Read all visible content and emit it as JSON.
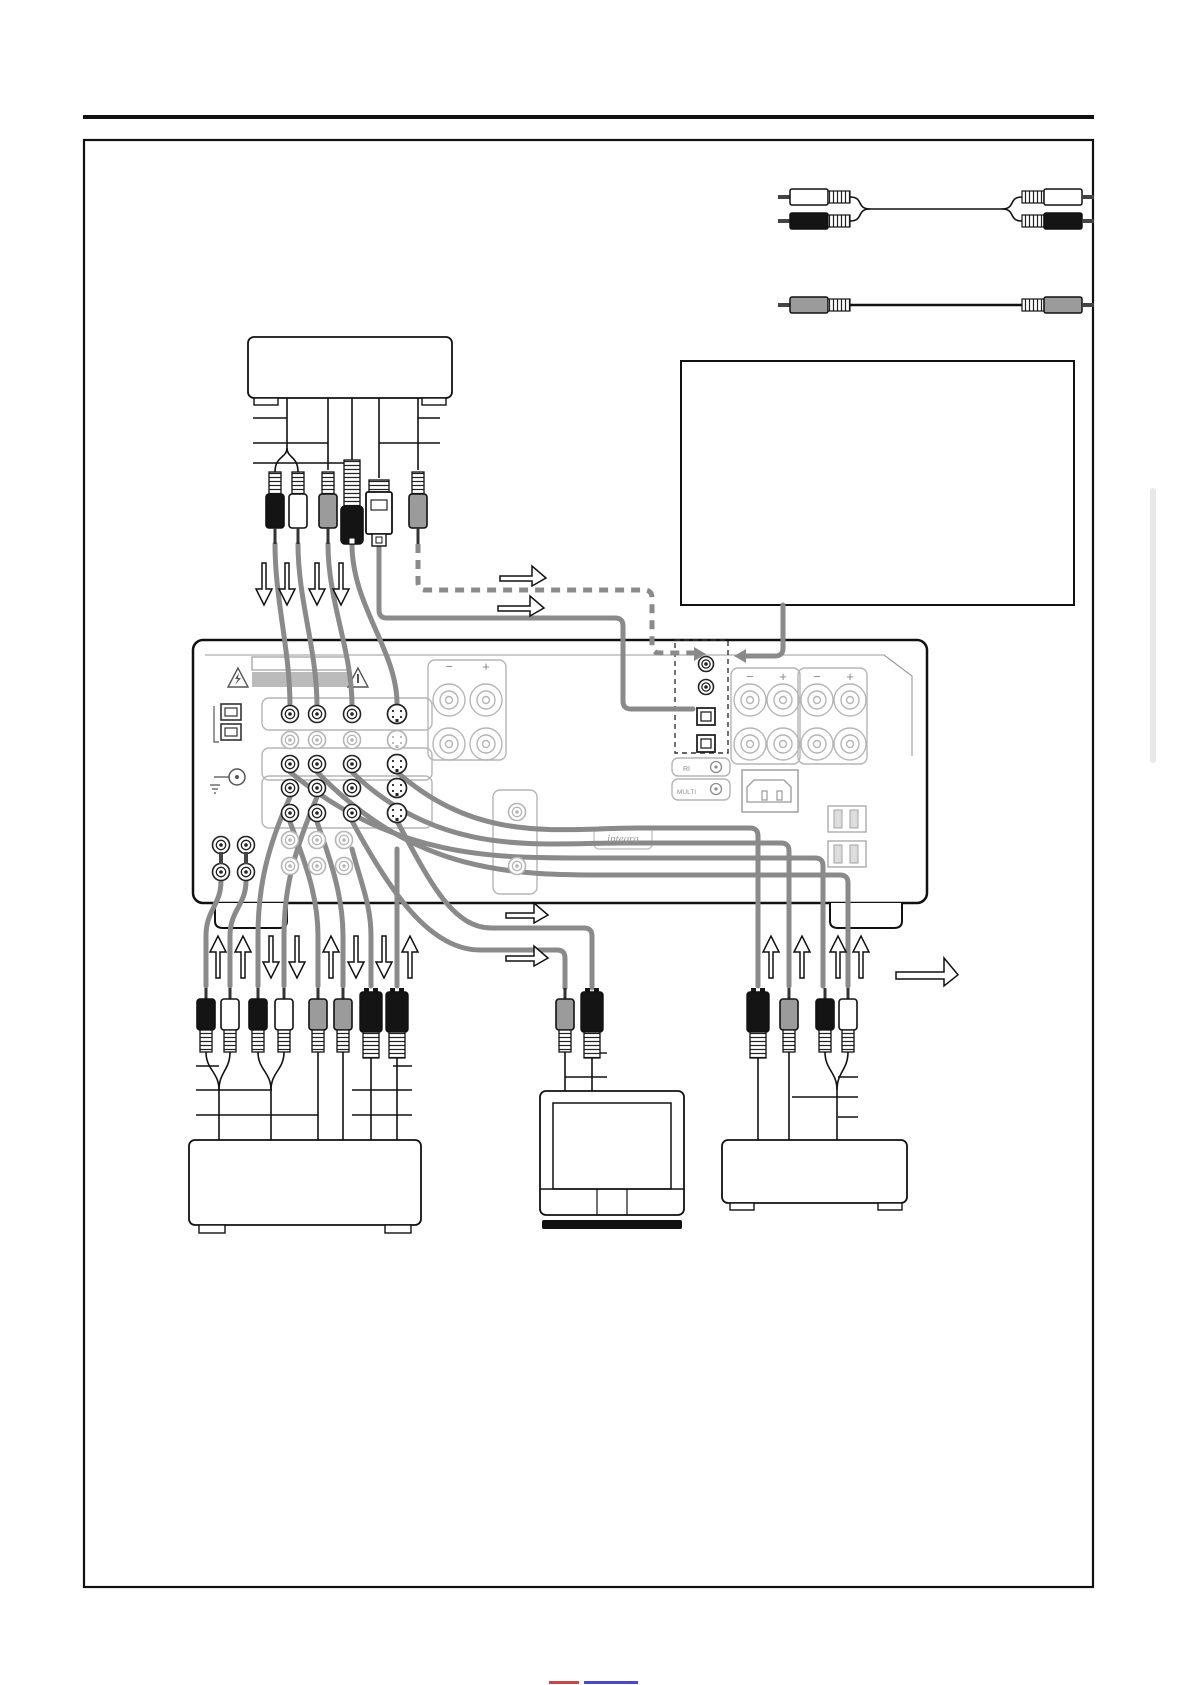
{
  "document": {
    "kind": "av-receiver rear-panel connection diagram page",
    "visible_text_note": "page contains almost no text; only speaker polarity marks, brand plate and two tiny jack labels"
  },
  "labels": {
    "speaker_minus": "−",
    "speaker_plus": "+",
    "brand_logo": "integra",
    "mini_jacks": [
      "RI",
      "MULTI"
    ]
  },
  "footer": {
    "cropped_link_fragments": [
      [
        549,
        1681,
        30,
        3,
        "#c24a4a"
      ],
      [
        584,
        1681,
        54,
        3,
        "#4a4ac2"
      ]
    ]
  },
  "colors": {
    "cable_gray": "#8a8a8a",
    "plug_black": "#141414",
    "plug_white": "#ffffff",
    "plug_gray": "#9b9b9b",
    "panel_light": "#b5b5b5",
    "page_tab_gray": "#e8e8e8"
  },
  "legend_cables": {
    "stereo_audio_cable": {
      "type": "rca-stereo-pair",
      "connector_colors": [
        "white",
        "black"
      ],
      "y1": 197,
      "y2": 221,
      "mid_y": 209,
      "x0": 790,
      "x1": 1082
    },
    "video_cable": {
      "type": "rca-mono",
      "connector_colors": [
        "gray"
      ],
      "y": 305,
      "x0": 790,
      "x1": 1082
    }
  },
  "geometry": {
    "page_rule": [
      83,
      115,
      1094,
      4
    ],
    "outer_box": [
      84,
      140,
      1009,
      1447
    ],
    "gray_strip": [
      1150,
      488,
      6,
      275
    ],
    "note_box": [
      681,
      361,
      393,
      244
    ],
    "top_device": {
      "box": [
        248,
        337,
        204,
        61
      ],
      "feet": [
        [
          254,
          398,
          24,
          7
        ],
        [
          422,
          398,
          24,
          7
        ]
      ]
    },
    "left_device": {
      "box": [
        189,
        1140,
        232,
        85
      ],
      "feet": [
        [
          199,
          1225,
          26,
          8
        ],
        [
          385,
          1225,
          26,
          8
        ]
      ]
    },
    "right_device": {
      "box": [
        722,
        1140,
        185,
        63
      ],
      "feet": [
        [
          730,
          1203,
          24,
          7
        ],
        [
          878,
          1203,
          24,
          7
        ]
      ]
    },
    "tv": {
      "box": [
        540,
        1091,
        144,
        124
      ],
      "screen": [
        553,
        1103,
        118,
        86
      ],
      "band_y": 1189,
      "dividers": [
        597,
        627
      ],
      "base": [
        542,
        1220,
        140,
        9
      ]
    }
  },
  "receiver": {
    "panel": [
      193,
      640,
      734,
      263
    ],
    "bevel": "M205,655 H884 L912,676 V756",
    "feet": [
      "M215,903 v18 q0,7 8,7 h56 q8,0 8,-7 v-18",
      "M830,903 v18 q0,7 8,7 h56 q8,0 8,-7 v-18"
    ],
    "warn_strip_outline": [
      252,
      657,
      96,
      13
    ],
    "warn_strip_fill": [
      252,
      672,
      96,
      15
    ],
    "warn_triangles": [
      [
        238,
        678
      ],
      [
        358,
        678
      ]
    ],
    "optical_in_left": [
      [
        221,
        704
      ],
      [
        221,
        724
      ]
    ],
    "ground": {
      "circle": [
        237,
        777,
        8
      ],
      "lead": [
        214,
        777,
        229,
        777
      ]
    },
    "jack_cols": [
      290,
      317,
      352
    ],
    "svideo_col": 397,
    "jack_rows": [
      {
        "y": 714,
        "tone": "dark",
        "sv": true
      },
      {
        "y": 740,
        "tone": "light",
        "sv": true
      },
      {
        "y": 764,
        "tone": "dark",
        "sv": true
      },
      {
        "y": 788,
        "tone": "dark",
        "sv": true
      },
      {
        "y": 813,
        "tone": "dark",
        "sv": true
      },
      {
        "y": 840,
        "tone": "light",
        "sv": false,
        "cols": [
          290,
          317,
          344
        ]
      },
      {
        "y": 866,
        "tone": "light",
        "sv": false,
        "cols": [
          290,
          317,
          344
        ]
      }
    ],
    "extra_light_jacks": [
      [
        517,
        812
      ],
      [
        517,
        866
      ]
    ],
    "quad_jacks": [
      [
        221,
        845
      ],
      [
        246,
        845
      ],
      [
        221,
        872
      ],
      [
        246,
        872
      ]
    ],
    "group_rects": [
      [
        262,
        698,
        170,
        32
      ],
      [
        262,
        748,
        170,
        32
      ],
      [
        262,
        776,
        170,
        52
      ],
      [
        493,
        790,
        44,
        104
      ],
      [
        428,
        660,
        78,
        100
      ],
      [
        731,
        668,
        69,
        96
      ],
      [
        798,
        668,
        69,
        96
      ]
    ],
    "digital_box": [
      675,
      640,
      53,
      113
    ],
    "coax_jacks": [
      [
        706,
        664
      ],
      [
        706,
        687
      ]
    ],
    "optical_jacks": [
      [
        697,
        708
      ],
      [
        697,
        735
      ]
    ],
    "center_speakers": {
      "cols": [
        449,
        486
      ],
      "rows": [
        700,
        744
      ],
      "label_y": 671,
      "labels": [
        "speaker_minus",
        "speaker_plus"
      ]
    },
    "right_speakers": {
      "cols": [
        750,
        783,
        817,
        850
      ],
      "rows": [
        700,
        744
      ],
      "label_y": 681,
      "labels": [
        "speaker_minus",
        "speaker_plus",
        "speaker_minus",
        "speaker_plus"
      ]
    },
    "ac_inlet": {
      "outer": [
        742,
        770,
        56,
        42
      ],
      "inner": "M754,780 h30 l7,7 v15 h-44 v-15 z",
      "pins": [
        [
          762,
          791,
          5,
          9
        ],
        [
          777,
          791,
          5,
          9
        ]
      ]
    },
    "outlets": [
      [
        828,
        806,
        38,
        26
      ],
      [
        828,
        841,
        38,
        26
      ]
    ],
    "logo_plate": [
      594,
      827,
      58,
      22
    ],
    "mini_jack_plates": [
      [
        672,
        758,
        58,
        18
      ],
      [
        672,
        779,
        58,
        21
      ]
    ],
    "mini_jack_circles": [
      [
        716,
        767
      ],
      [
        716,
        789
      ]
    ]
  },
  "cables": {
    "gray": [
      {
        "name": "source-audio-left",
        "d": "M275,544 C275,600 290,650 290,706"
      },
      {
        "name": "source-audio-right",
        "d": "M298,544 C298,600 317,650 317,706"
      },
      {
        "name": "source-video",
        "d": "M328,544 C328,602 352,650 352,706"
      },
      {
        "name": "source-svideo",
        "d": "M352,544 C352,606 397,650 397,704"
      },
      {
        "name": "optical-digital",
        "d": "M379,546 V610 Q379,618 387,618 H615 Q623,618 623,626 V701 Q623,709 631,709 H693"
      },
      {
        "name": "note-box-lead",
        "d": "M783,605 V648 Q783,656 775,656 H744"
      },
      {
        "name": "right-svideo",
        "d": "M397,772 C480,845 560,828 640,828 H750 Q758,828 758,836 V986"
      },
      {
        "name": "right-video",
        "d": "M352,772 C440,858 540,843 620,843 H781 Q789,843 789,851 V986"
      },
      {
        "name": "right-audio-l",
        "d": "M290,772 C400,862 500,858 600,858 H815 Q823,858 823,866 V986"
      },
      {
        "name": "right-audio-r",
        "d": "M317,772 C420,878 520,875 620,875 H840 Q848,875 848,883 V986"
      },
      {
        "name": "tv-video",
        "d": "M352,821 C390,892 430,950 480,950 H557 Q565,950 565,958 V988"
      },
      {
        "name": "tv-svideo",
        "d": "M397,821 C430,882 452,928 492,928 H584 Q592,928 592,936 V988"
      },
      {
        "name": "left-1",
        "d": "M221,881 C221,905 206,910 206,936 V986"
      },
      {
        "name": "left-2",
        "d": "M246,881 C246,905 230,910 230,936 V986"
      },
      {
        "name": "left-3",
        "d": "M290,797 C265,852 258,892 258,936 V986"
      },
      {
        "name": "left-4",
        "d": "M317,797 C292,856 284,892 284,936 V986"
      },
      {
        "name": "left-5",
        "d": "M290,822 C305,862 318,896 318,936 V986"
      },
      {
        "name": "left-6",
        "d": "M317,822 C332,864 343,898 343,936 V986"
      },
      {
        "name": "left-7",
        "d": "M352,849 C362,886 371,906 371,936 V986"
      },
      {
        "name": "left-8",
        "d": "M397,849 V986"
      }
    ],
    "dashed": [
      {
        "name": "coax-digital-dashed",
        "d": "M418,544 V582 Q418,590 426,590 H644 Q652,590 652,598 V645 Q652,653 660,653 H694"
      }
    ],
    "arrowheads": [
      [
        [
          694,
          647
        ],
        [
          706,
          654
        ],
        [
          694,
          661
        ]
      ],
      [
        [
          746,
          649
        ],
        [
          734,
          656
        ],
        [
          746,
          663
        ]
      ]
    ],
    "thin": [
      "M287,398 V448",
      "M328,398 V470",
      "M352,398 V460",
      "M379,398 V478",
      "M418,398 V470",
      "M287,448 C287,458 275,456 275,472",
      "M287,448 C287,458 298,456 298,472",
      "M206,1052 C206,1070 219,1072 219,1090",
      "M230,1052 C230,1070 219,1072 219,1090",
      "M219,1090 V1140",
      "M258,1052 C258,1070 271,1072 271,1090",
      "M284,1052 C284,1070 271,1072 271,1090",
      "M271,1090 V1140",
      "M318,1052 V1140",
      "M343,1052 V1140",
      "M371,1058 V1140",
      "M397,1058 V1140",
      "M758,1058 V1140",
      "M789,1052 V1140",
      "M825,1052 C825,1070 837,1072 837,1090",
      "M848,1052 C848,1070 837,1072 837,1090",
      "M837,1090 V1140",
      "M565,1052 V1091",
      "M592,1058 V1091"
    ]
  },
  "plugs": {
    "down": [
      {
        "x": 275,
        "color": "black",
        "type": "rca"
      },
      {
        "x": 298,
        "color": "white",
        "type": "rca"
      },
      {
        "x": 328,
        "color": "gray",
        "type": "rca"
      },
      {
        "x": 352,
        "color": "black",
        "type": "coax-big"
      },
      {
        "x": 379,
        "color": "white",
        "type": "optical"
      },
      {
        "x": 418,
        "color": "gray",
        "type": "rca"
      }
    ],
    "up": [
      {
        "x": 206,
        "color": "black",
        "type": "rca"
      },
      {
        "x": 230,
        "color": "white",
        "type": "rca"
      },
      {
        "x": 258,
        "color": "black",
        "type": "rca"
      },
      {
        "x": 284,
        "color": "white",
        "type": "rca"
      },
      {
        "x": 318,
        "color": "gray",
        "type": "rca"
      },
      {
        "x": 343,
        "color": "gray",
        "type": "rca"
      },
      {
        "x": 371,
        "type": "svideo"
      },
      {
        "x": 397,
        "type": "svideo"
      },
      {
        "x": 758,
        "type": "svideo"
      },
      {
        "x": 789,
        "color": "gray",
        "type": "rca"
      },
      {
        "x": 825,
        "color": "black",
        "type": "rca"
      },
      {
        "x": 848,
        "color": "white",
        "type": "rca"
      },
      {
        "x": 565,
        "color": "gray",
        "type": "rca"
      },
      {
        "x": 592,
        "type": "svideo"
      }
    ]
  },
  "arrows": {
    "vertical": [
      {
        "x": 264,
        "y": 563,
        "dir": "down"
      },
      {
        "x": 287,
        "y": 563,
        "dir": "down"
      },
      {
        "x": 317,
        "y": 563,
        "dir": "down"
      },
      {
        "x": 341,
        "y": 563,
        "dir": "down"
      },
      {
        "x": 218,
        "y": 936,
        "dir": "up"
      },
      {
        "x": 243,
        "y": 936,
        "dir": "up"
      },
      {
        "x": 271,
        "y": 936,
        "dir": "down"
      },
      {
        "x": 297,
        "y": 936,
        "dir": "down"
      },
      {
        "x": 331,
        "y": 936,
        "dir": "up"
      },
      {
        "x": 356,
        "y": 936,
        "dir": "down"
      },
      {
        "x": 384,
        "y": 936,
        "dir": "down"
      },
      {
        "x": 410,
        "y": 936,
        "dir": "up"
      },
      {
        "x": 771,
        "y": 936,
        "dir": "up"
      },
      {
        "x": 802,
        "y": 936,
        "dir": "up"
      },
      {
        "x": 838,
        "y": 936,
        "dir": "up"
      },
      {
        "x": 861,
        "y": 936,
        "dir": "up"
      }
    ],
    "step_right": [
      {
        "x": 500,
        "y": 566,
        "w": 46,
        "h": 20
      },
      {
        "x": 498,
        "y": 596,
        "w": 46,
        "h": 20
      },
      {
        "x": 506,
        "y": 903,
        "w": 42,
        "h": 20
      },
      {
        "x": 506,
        "y": 946,
        "w": 42,
        "h": 20
      },
      {
        "x": 896,
        "y": 958,
        "w": 62,
        "h": 28
      }
    ]
  },
  "ticks": [
    [
      253,
      418,
      287,
      418
    ],
    [
      253,
      443,
      328,
      443
    ],
    [
      253,
      463,
      352,
      463
    ],
    [
      418,
      418,
      440,
      418
    ],
    [
      379,
      443,
      440,
      443
    ],
    [
      196,
      1066,
      219,
      1066
    ],
    [
      393,
      1066,
      412,
      1066
    ],
    [
      196,
      1090,
      272,
      1090
    ],
    [
      352,
      1090,
      412,
      1090
    ],
    [
      196,
      1115,
      318,
      1115
    ],
    [
      352,
      1115,
      412,
      1115
    ],
    [
      592,
      1053,
      607,
      1053
    ],
    [
      565,
      1077,
      607,
      1077
    ],
    [
      838,
      1077,
      858,
      1077
    ],
    [
      792,
      1097,
      858,
      1097
    ],
    [
      838,
      1117,
      858,
      1117
    ]
  ]
}
